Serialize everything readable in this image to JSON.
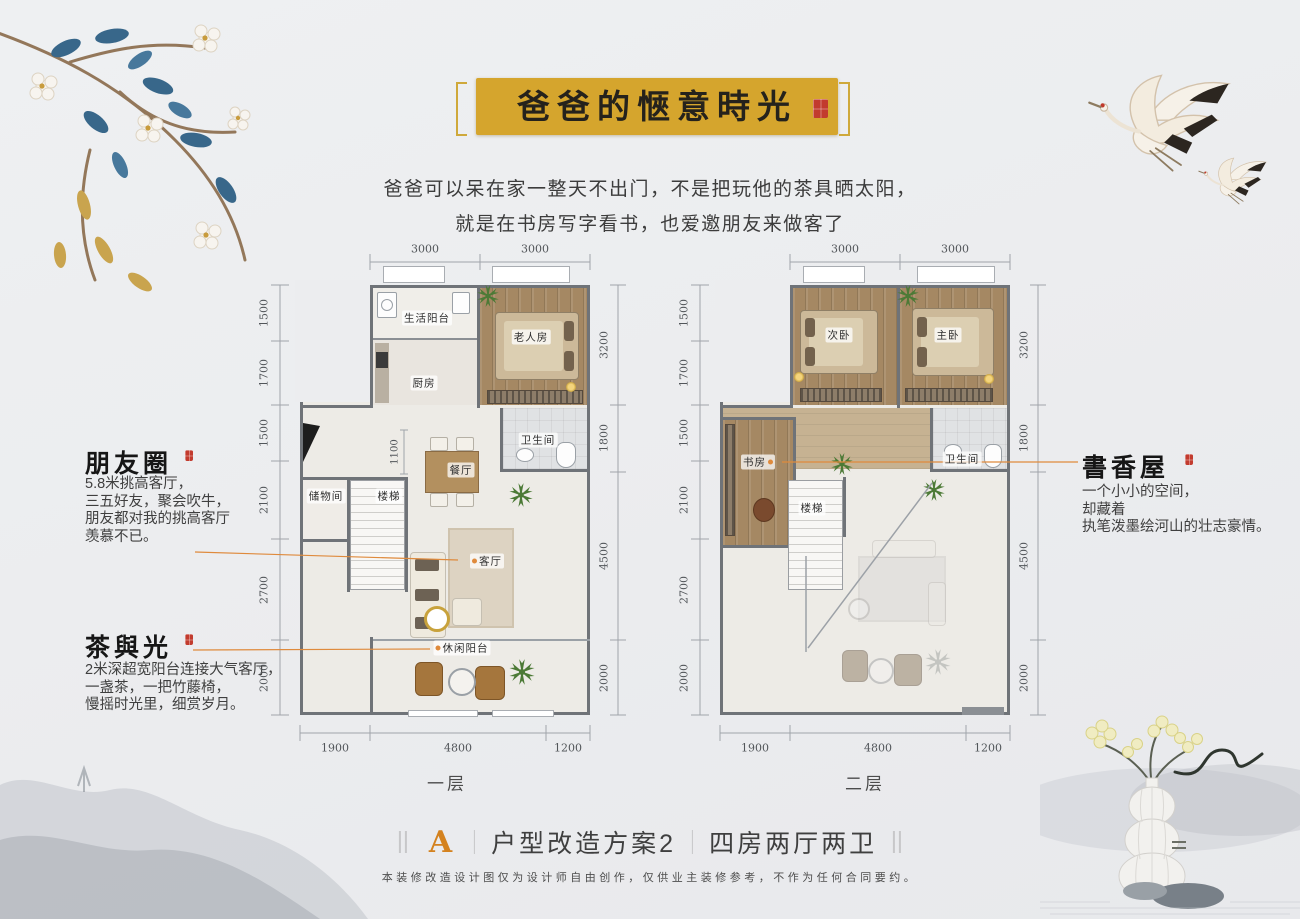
{
  "banner": {
    "title": "爸爸的愜意時光"
  },
  "intro": {
    "line1": "爸爸可以呆在家一整天不出门，不是把玩他的茶具晒太阳，",
    "line2": "就是在书房写字看书，也爱邀朋友来做客了"
  },
  "annotations": {
    "friends": {
      "title": "朋友圈",
      "line1": "5.8米挑高客厅，",
      "line2": "三五好友，聚会吹牛，",
      "line3": "朋友都对我的挑高客厅",
      "line4": "羡慕不已。"
    },
    "tea": {
      "title": "茶與光",
      "line1": "2米深超宽阳台连接大气客厅，",
      "line2": "一盏茶，一把竹藤椅，",
      "line3": "慢摇时光里，细赏岁月。"
    },
    "study": {
      "title": "書香屋",
      "line1": "一个小小的空间，",
      "line2": "却藏着",
      "line3": "执笔泼墨绘河山的壮志豪情。"
    }
  },
  "floor1": {
    "label": "一层",
    "dims_top": [
      "3000",
      "3000"
    ],
    "dims_left": [
      "1500",
      "1700",
      "1500",
      "2100",
      "2700",
      "2000"
    ],
    "dims_right": [
      "3200",
      "1800",
      "4500",
      "2000"
    ],
    "dims_bottom": [
      "1900",
      "4800",
      "1200"
    ],
    "dim_inner": "1100",
    "rooms": {
      "service_balcony": "生活阳台",
      "elder_room": "老人房",
      "kitchen": "厨房",
      "bathroom": "卫生间",
      "dining": "餐厅",
      "storage": "储物间",
      "stairs": "楼梯",
      "living": "客厅",
      "leisure_balcony": "休闲阳台"
    }
  },
  "floor2": {
    "label": "二层",
    "dims_top": [
      "3000",
      "3000"
    ],
    "dims_left": [
      "1500",
      "1700",
      "1500",
      "2100",
      "2700",
      "2000"
    ],
    "dims_right": [
      "3200",
      "1800",
      "4500",
      "2000"
    ],
    "dims_bottom": [
      "1900",
      "4800",
      "1200"
    ],
    "rooms": {
      "second_bedroom": "次卧",
      "master_bedroom": "主卧",
      "study": "书房",
      "bathroom": "卫生间",
      "stairs": "楼梯"
    }
  },
  "footer": {
    "plan_letter": "A",
    "caption_scheme": "户型改造方案2",
    "caption_layout": "四房两厅两卫",
    "disclaimer": "本装修改造设计图仅为设计师自由创作，仅供业主装修参考，不作为任何合同要约。"
  },
  "colors": {
    "banner_gold": "#d5a52d",
    "accent_orange": "#df8a3c",
    "seal_red": "#c23b2e",
    "wall_gray": "#6f7378",
    "wood": "#a58863"
  }
}
